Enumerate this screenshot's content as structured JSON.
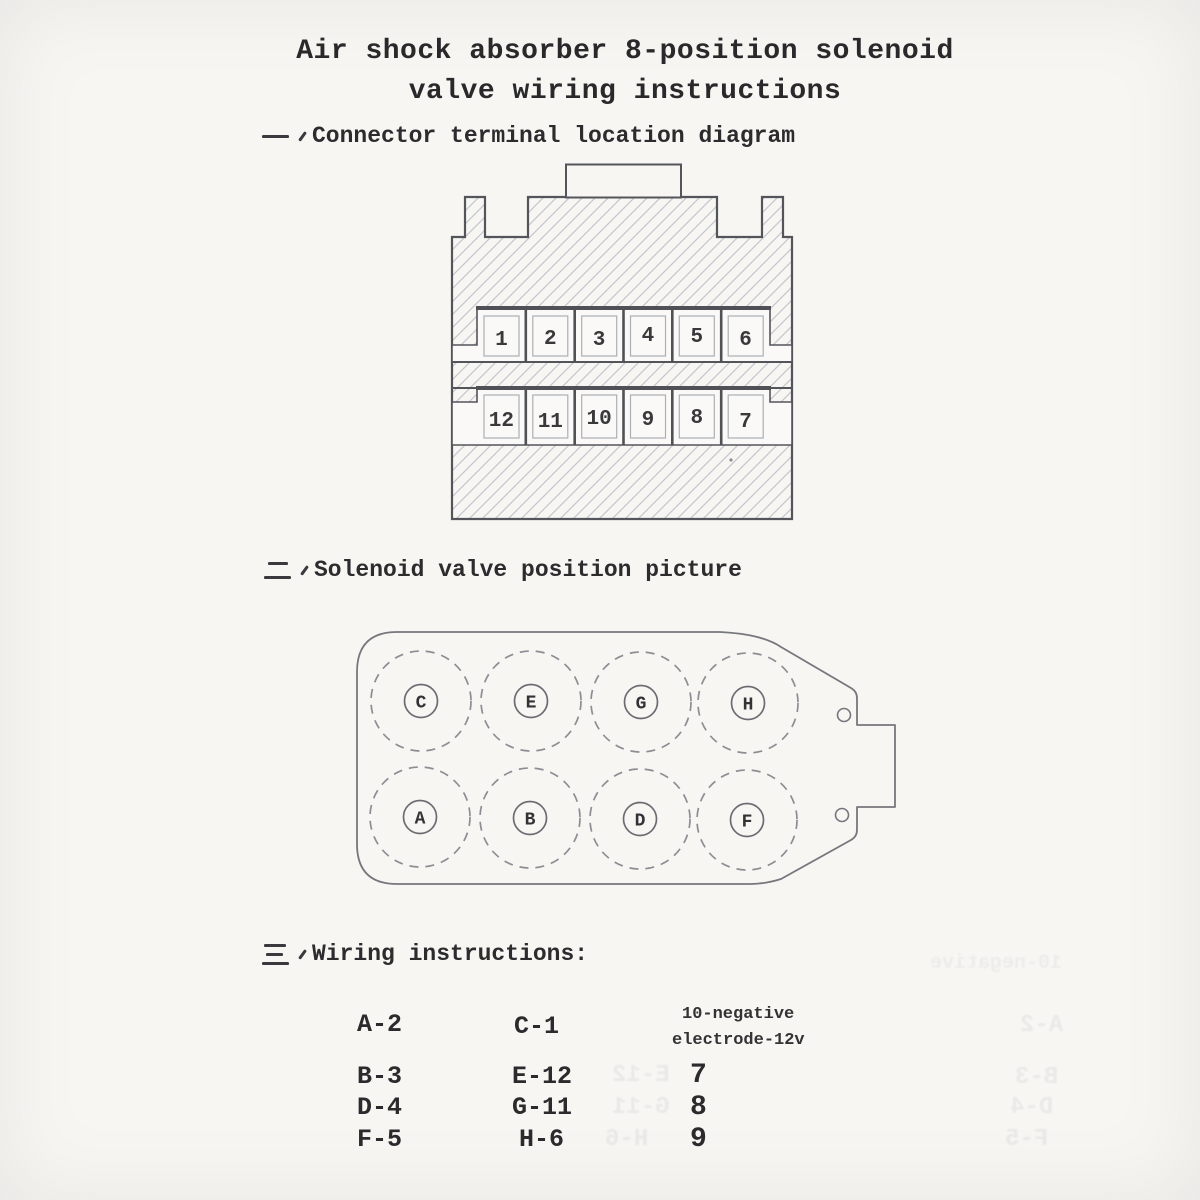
{
  "page": {
    "paper_color": "#f7f6f3",
    "ink_color": "#2e2e30",
    "diagram_line_color": "#55565c",
    "hatch_color": "#c4c5cd"
  },
  "title": {
    "line1": "Air shock absorber 8-position solenoid",
    "line2": "valve wiring instructions"
  },
  "sections": [
    {
      "marker_glyph": "一、",
      "heading": "Connector terminal location diagram"
    },
    {
      "marker_glyph": "二、",
      "heading": "Solenoid valve position picture"
    },
    {
      "marker_glyph": "三、",
      "heading": "Wiring instructions:"
    }
  ],
  "connector": {
    "top_row": [
      "1",
      "2",
      "3",
      "4",
      "5",
      "6"
    ],
    "bottom_row": [
      "12",
      "11",
      "10",
      "9",
      "8",
      "7"
    ]
  },
  "valve": {
    "top_row": [
      "C",
      "E",
      "G",
      "H"
    ],
    "bottom_row": [
      "A",
      "B",
      "D",
      "F"
    ]
  },
  "wiring": {
    "column1": [
      "A-2",
      "B-3",
      "D-4",
      "F-5"
    ],
    "column2": [
      "C-1",
      "E-12",
      "G-11",
      "H-6"
    ],
    "note_line1": "10-negative",
    "note_line2": "electrode-12v",
    "column3": [
      "7",
      "8",
      "9"
    ]
  },
  "ghost_bleedthrough": [
    "E-12",
    "G-11",
    "H-6",
    "A-2",
    "B-3",
    "D-4",
    "F-5",
    "10-negative"
  ]
}
